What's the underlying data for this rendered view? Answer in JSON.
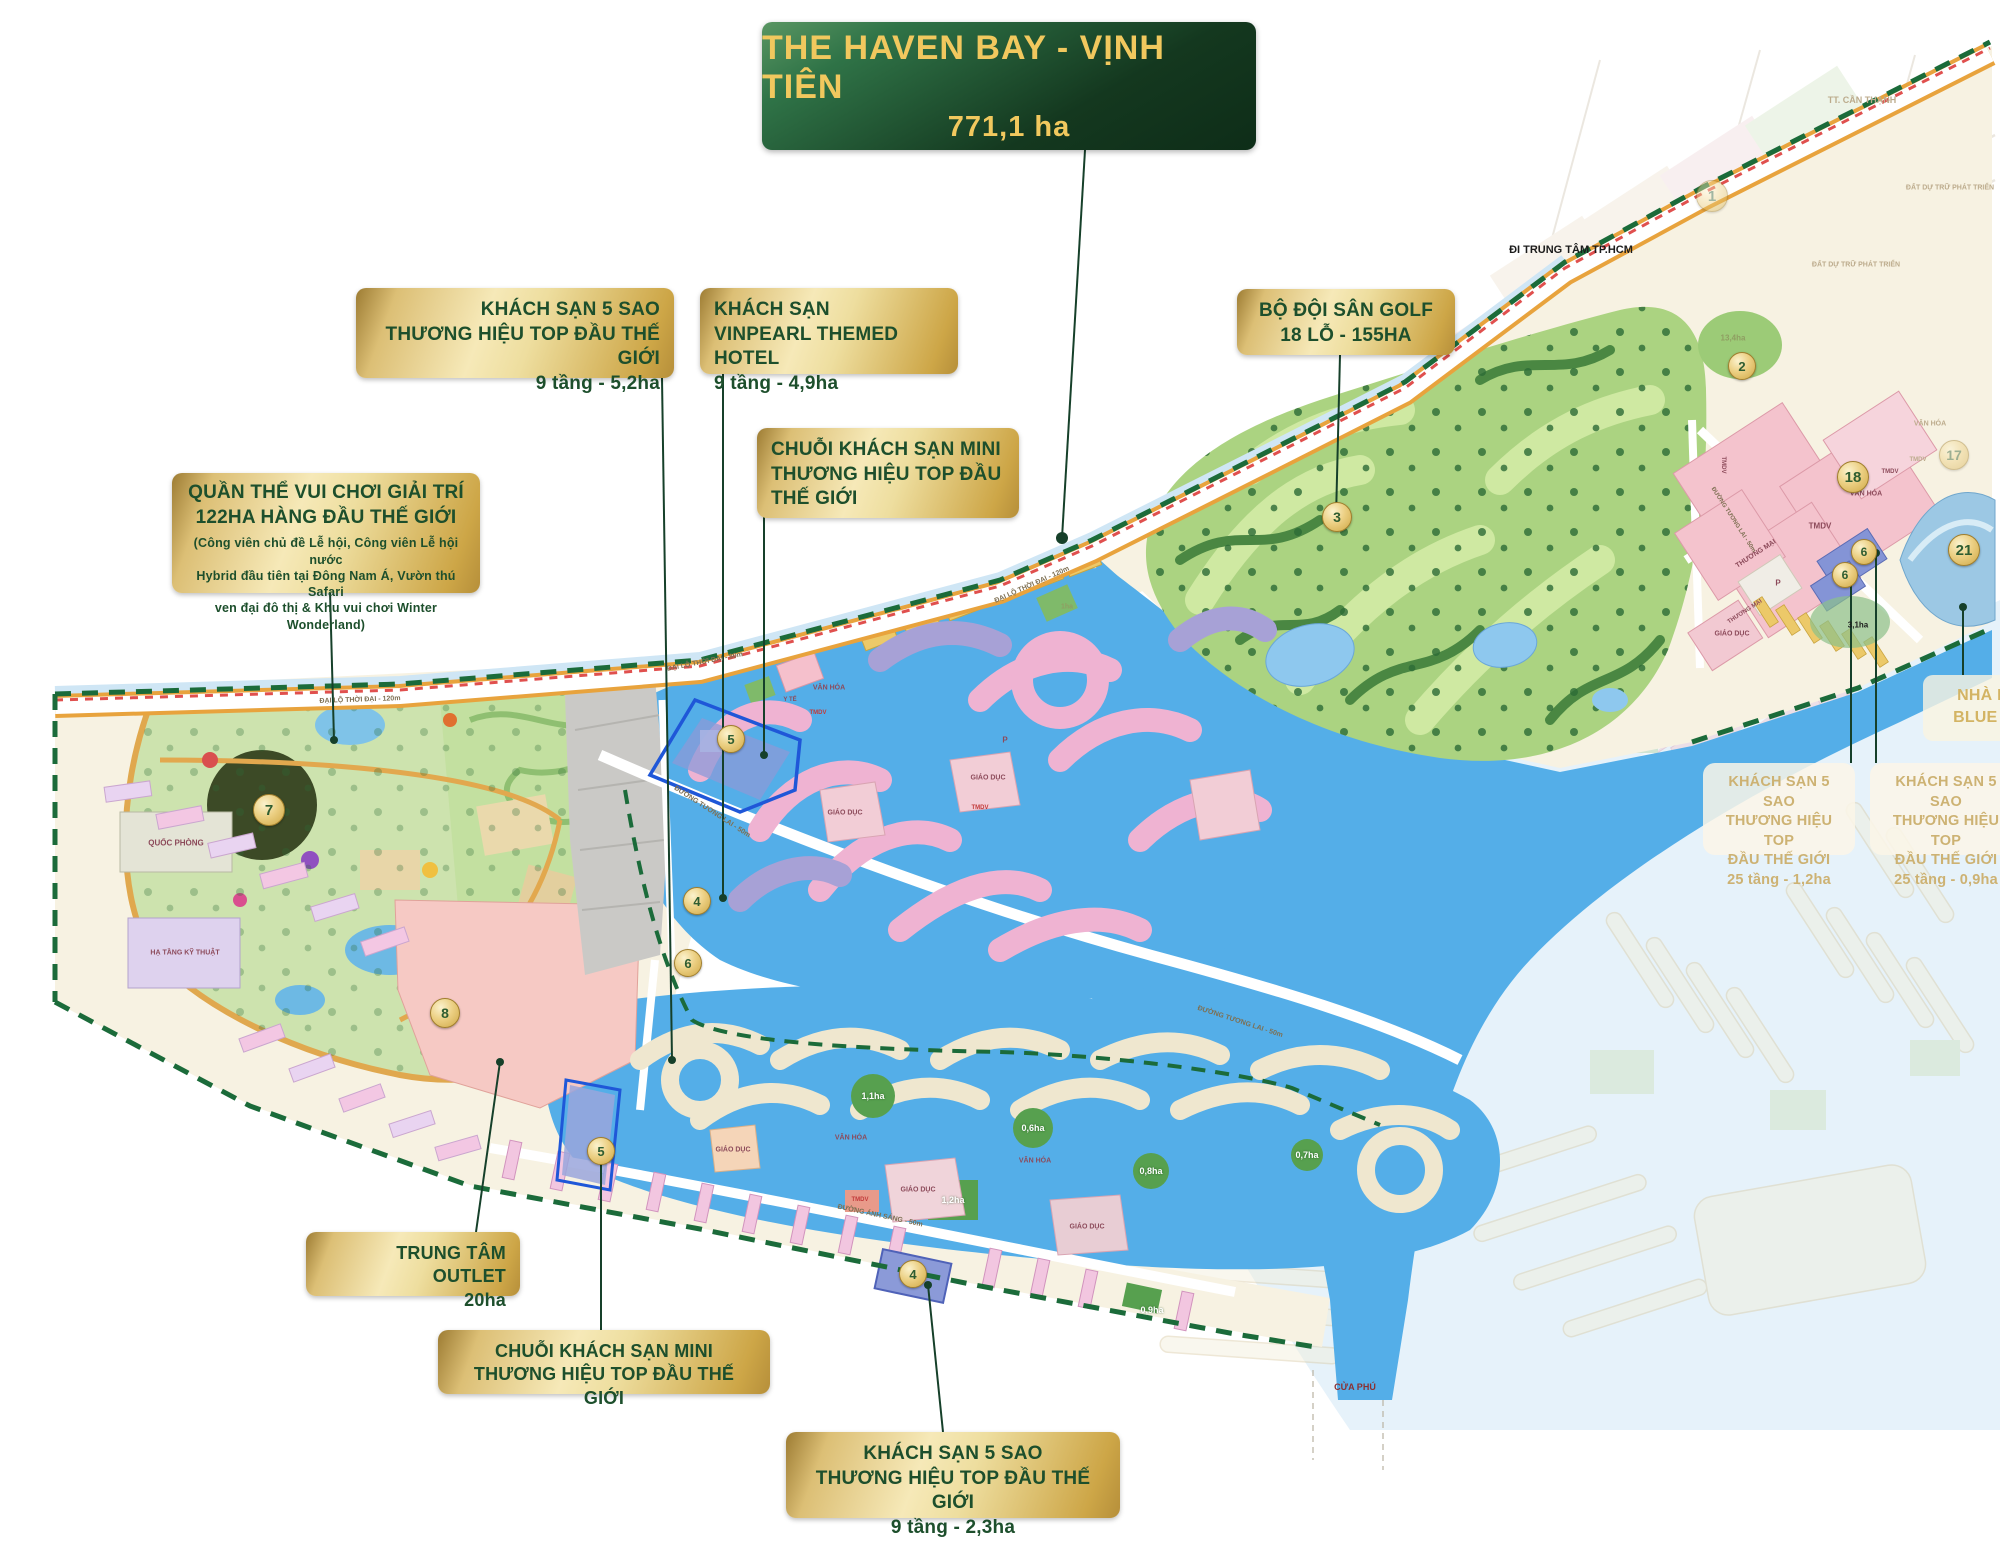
{
  "banner": {
    "title": "THE HAVEN BAY - VỊNH TIÊN",
    "subtitle": "771,1 ha"
  },
  "colors": {
    "banner_green": "#14381f",
    "gold": "#d9b851",
    "text_green": "#1d4f2c",
    "water": "#54aee8",
    "golf": "#abd381",
    "boundary_dash": "#1b6b3a",
    "rail_dash": "#e0504e"
  },
  "callouts": {
    "hotel52": {
      "l1": "KHÁCH SẠN 5 SAO",
      "l2": "THƯƠNG HIỆU TOP ĐẦU THẾ GIỚI",
      "l3": "9 tầng - 5,2ha"
    },
    "vinpearl": {
      "l1": "KHÁCH SẠN",
      "l2": "VINPEARL THEMED HOTEL",
      "l3": "9 tầng - 4,9ha"
    },
    "golf": {
      "l1": "BỘ ĐỘI SÂN GOLF",
      "l2": "18 LỖ - 155HA"
    },
    "mini_top": {
      "l1": "CHUỖI KHÁCH SẠN MINI",
      "l2": "THƯƠNG HIỆU TOP ĐẦU",
      "l3": "THẾ GIỚI"
    },
    "park": {
      "l1": "QUẦN THỂ VUI CHƠI GIẢI TRÍ",
      "l2": "122HA HÀNG ĐẦU THẾ GIỚI",
      "s1": "(Công viên chủ đề Lễ hội, Công viên Lễ hội nước",
      "s2": "Hybrid đầu tiên tại Đông Nam Á, Vườn thú Safari",
      "s3": "ven đại đô thị & Khu vui chơi Winter Wonderland)"
    },
    "outlet": {
      "l1": "TRUNG TÂM OUTLET",
      "l2": "20ha"
    },
    "mini_bottom": {
      "l1": "CHUỖI KHÁCH SẠN MINI",
      "l2": "THƯƠNG HIỆU TOP ĐẦU THẾ GIỚI"
    },
    "hotel23": {
      "l1": "KHÁCH SẠN 5 SAO",
      "l2": "THƯƠNG HIỆU TOP ĐẦU THẾ GIỚI",
      "l3": "9 tầng - 2,3ha"
    },
    "hotel25a": {
      "l1": "KHÁCH SẠN 5 SAO",
      "l2": "THƯƠNG HIỆU TOP",
      "l3": "ĐẦU THẾ GIỚI",
      "l4": "25 tầng - 1,2ha"
    },
    "hotel25b": {
      "l1": "KHÁCH SẠN 5 SAO",
      "l2": "THƯƠNG HIỆU TOP",
      "l3": "ĐẦU THẾ GIỚI",
      "l4": "25 tầng - 0,9ha"
    },
    "bluev": {
      "l1": "NHÀ H",
      "l2": "BLUE V"
    }
  },
  "map_labels": [
    {
      "t": "ĐI TRUNG TÂM TP.HCM",
      "x": 1571,
      "y": 250,
      "cls": "dark",
      "fs": 11
    },
    {
      "t": "TT. CẦN THẠNH",
      "x": 1862,
      "y": 100,
      "cls": "faded",
      "fs": 9
    },
    {
      "t": "ĐẤT DỰ TRỮ PHÁT TRIỂN",
      "x": 1950,
      "y": 188,
      "cls": "faded",
      "fs": 7
    },
    {
      "t": "ĐẤT DỰ TRỮ PHÁT TRIỂN",
      "x": 1856,
      "y": 265,
      "cls": "faded",
      "fs": 7
    },
    {
      "t": "QUỐC PHÒNG",
      "x": 176,
      "y": 843,
      "cls": "zone",
      "fs": 8
    },
    {
      "t": "HẠ TẦNG KỸ THUẬT",
      "x": 185,
      "y": 953,
      "cls": "zone",
      "fs": 7
    },
    {
      "t": "ĐẠI LỘ THỜI ĐẠI - 120m",
      "x": 360,
      "y": 700,
      "cls": "road",
      "fs": 7,
      "r": -2
    },
    {
      "t": "ĐẠI LỘ THỜI ĐẠI - 80m",
      "x": 705,
      "y": 662,
      "cls": "road",
      "fs": 7,
      "r": -11
    },
    {
      "t": "ĐẠI LỘ THỜI ĐẠI - 120m",
      "x": 1032,
      "y": 585,
      "cls": "road",
      "fs": 7,
      "r": -24
    },
    {
      "t": "ĐƯỜNG TƯƠNG LAI - 50m",
      "x": 712,
      "y": 812,
      "cls": "road",
      "fs": 7,
      "r": 33
    },
    {
      "t": "ĐƯỜNG TƯƠNG LAI - 50m",
      "x": 1240,
      "y": 1022,
      "cls": "road",
      "fs": 7,
      "r": 18
    },
    {
      "t": "ĐƯỜNG ÁNH SÁNG - 50m",
      "x": 880,
      "y": 1216,
      "cls": "road",
      "fs": 7,
      "r": 12
    },
    {
      "t": "VĂN HÓA",
      "x": 829,
      "y": 688,
      "cls": "zone",
      "fs": 7
    },
    {
      "t": "TMDV",
      "x": 818,
      "y": 713,
      "cls": "zone-red",
      "fs": 6
    },
    {
      "t": "Y TẾ",
      "x": 790,
      "y": 700,
      "cls": "zone",
      "fs": 6
    },
    {
      "t": "GIÁO DỤC",
      "x": 845,
      "y": 813,
      "cls": "zone",
      "fs": 7
    },
    {
      "t": "GIÁO DỤC",
      "x": 988,
      "y": 778,
      "cls": "zone",
      "fs": 7
    },
    {
      "t": "P",
      "x": 1005,
      "y": 740,
      "cls": "zone",
      "fs": 8
    },
    {
      "t": "TMDV",
      "x": 980,
      "y": 808,
      "cls": "zone-red",
      "fs": 6
    },
    {
      "t": "1ha",
      "x": 1067,
      "y": 607,
      "cls": "ha-sm",
      "fs": 7
    },
    {
      "t": "GIÁO DỤC",
      "x": 733,
      "y": 1150,
      "cls": "zone",
      "fs": 7
    },
    {
      "t": "VĂN HÓA",
      "x": 851,
      "y": 1138,
      "cls": "zone",
      "fs": 7
    },
    {
      "t": "VĂN HÓA",
      "x": 1035,
      "y": 1161,
      "cls": "zone",
      "fs": 7
    },
    {
      "t": "GIÁO DỤC",
      "x": 918,
      "y": 1190,
      "cls": "zone",
      "fs": 7
    },
    {
      "t": "TMDV",
      "x": 860,
      "y": 1200,
      "cls": "zone-red",
      "fs": 6
    },
    {
      "t": "GIÁO DỤC",
      "x": 1087,
      "y": 1227,
      "cls": "zone",
      "fs": 7
    },
    {
      "t": "1,1ha",
      "x": 873,
      "y": 1096,
      "cls": "ha",
      "fs": 9
    },
    {
      "t": "0,6ha",
      "x": 1033,
      "y": 1128,
      "cls": "ha",
      "fs": 9
    },
    {
      "t": "0,8ha",
      "x": 1151,
      "y": 1171,
      "cls": "ha",
      "fs": 9
    },
    {
      "t": "1,2ha",
      "x": 953,
      "y": 1200,
      "cls": "ha",
      "fs": 9
    },
    {
      "t": "0,9ha",
      "x": 1152,
      "y": 1310,
      "cls": "ha",
      "fs": 9
    },
    {
      "t": "0,7ha",
      "x": 1307,
      "y": 1155,
      "cls": "ha",
      "fs": 9
    },
    {
      "t": "13,4ha",
      "x": 1733,
      "y": 338,
      "cls": "ha-sm",
      "fs": 8
    },
    {
      "t": "3,1ha",
      "x": 1858,
      "y": 625,
      "cls": "dark",
      "fs": 8
    },
    {
      "t": "TMDV",
      "x": 1820,
      "y": 526,
      "cls": "zone",
      "fs": 8
    },
    {
      "t": "VĂN HÓA",
      "x": 1866,
      "y": 494,
      "cls": "zone",
      "fs": 7
    },
    {
      "t": "TMDV",
      "x": 1890,
      "y": 472,
      "cls": "zone",
      "fs": 6
    },
    {
      "t": "THƯƠNG MẠI",
      "x": 1756,
      "y": 554,
      "cls": "zone",
      "fs": 7,
      "r": -33
    },
    {
      "t": "P",
      "x": 1778,
      "y": 583,
      "cls": "zone",
      "fs": 8
    },
    {
      "t": "THƯƠNG MẠI",
      "x": 1745,
      "y": 612,
      "cls": "zone",
      "fs": 6,
      "r": -33
    },
    {
      "t": "GIÁO DỤC",
      "x": 1732,
      "y": 634,
      "cls": "zone",
      "fs": 7
    },
    {
      "t": "TMDV",
      "x": 1723,
      "y": 465,
      "cls": "zone",
      "fs": 6,
      "r": 90
    },
    {
      "t": "ĐƯỜNG TƯƠNG LAI - 50m",
      "x": 1733,
      "y": 520,
      "cls": "road",
      "fs": 6,
      "r": 57
    },
    {
      "t": "VĂN HÓA",
      "x": 1930,
      "y": 424,
      "cls": "faded",
      "fs": 7
    },
    {
      "t": "TMDV",
      "x": 1918,
      "y": 460,
      "cls": "faded",
      "fs": 6
    },
    {
      "t": "CỬA PHÚ",
      "x": 1355,
      "y": 1387,
      "cls": "river",
      "fs": 9
    }
  ],
  "badges": [
    {
      "n": "1",
      "x": 1712,
      "y": 196,
      "d": 30,
      "f": 1
    },
    {
      "n": "2",
      "x": 1742,
      "y": 366,
      "d": 26
    },
    {
      "n": "3",
      "x": 1337,
      "y": 517,
      "d": 28
    },
    {
      "n": "7",
      "x": 269,
      "y": 810,
      "d": 30
    },
    {
      "n": "8",
      "x": 445,
      "y": 1013,
      "d": 28
    },
    {
      "n": "5",
      "x": 731,
      "y": 739,
      "d": 26
    },
    {
      "n": "4",
      "x": 697,
      "y": 901,
      "d": 26
    },
    {
      "n": "6",
      "x": 688,
      "y": 963,
      "d": 26
    },
    {
      "n": "5",
      "x": 601,
      "y": 1151,
      "d": 26
    },
    {
      "n": "4",
      "x": 913,
      "y": 1274,
      "d": 26
    },
    {
      "n": "18",
      "x": 1853,
      "y": 477,
      "d": 30
    },
    {
      "n": "6",
      "x": 1864,
      "y": 552,
      "d": 24
    },
    {
      "n": "6",
      "x": 1845,
      "y": 575,
      "d": 24
    },
    {
      "n": "21",
      "x": 1964,
      "y": 550,
      "d": 30
    },
    {
      "n": "17",
      "x": 1954,
      "y": 455,
      "d": 28,
      "f": 1
    }
  ]
}
